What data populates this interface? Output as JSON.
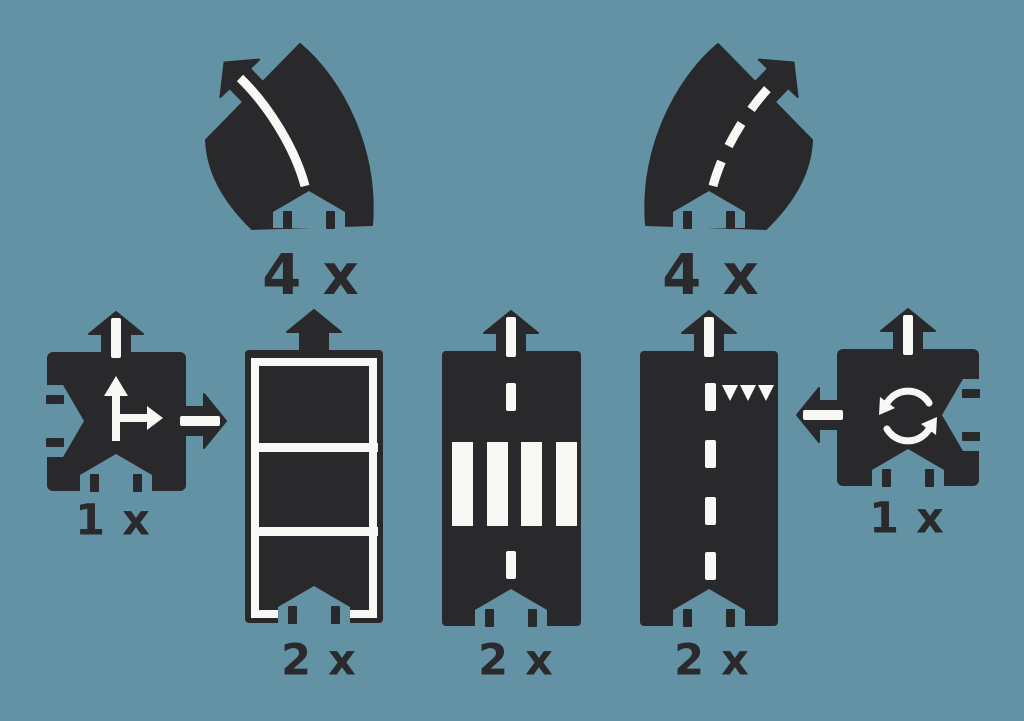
{
  "palette": {
    "background": "#6292a3",
    "piece": "#29292b",
    "marking": "#f8f8f5",
    "label_color": "#2a2a2c"
  },
  "pieces": [
    {
      "name": "curve-solid-line",
      "type": "curved road, solid center line",
      "label": "4 x"
    },
    {
      "name": "curve-dashed-line",
      "type": "curved road, dashed center line",
      "label": "4 x"
    },
    {
      "name": "t-junction",
      "type": "square junction with arrow markings",
      "label": "1 x"
    },
    {
      "name": "bridge-straight",
      "type": "straight road with guardrail frame",
      "label": "2 x"
    },
    {
      "name": "pedestrian-crossing-straight",
      "type": "straight road with zebra crossing",
      "label": "2 x"
    },
    {
      "name": "give-way-straight",
      "type": "straight road with give-way triangles",
      "label": "2 x"
    },
    {
      "name": "roundabout",
      "type": "square piece with roundabout arrows",
      "label": "1 x"
    }
  ]
}
